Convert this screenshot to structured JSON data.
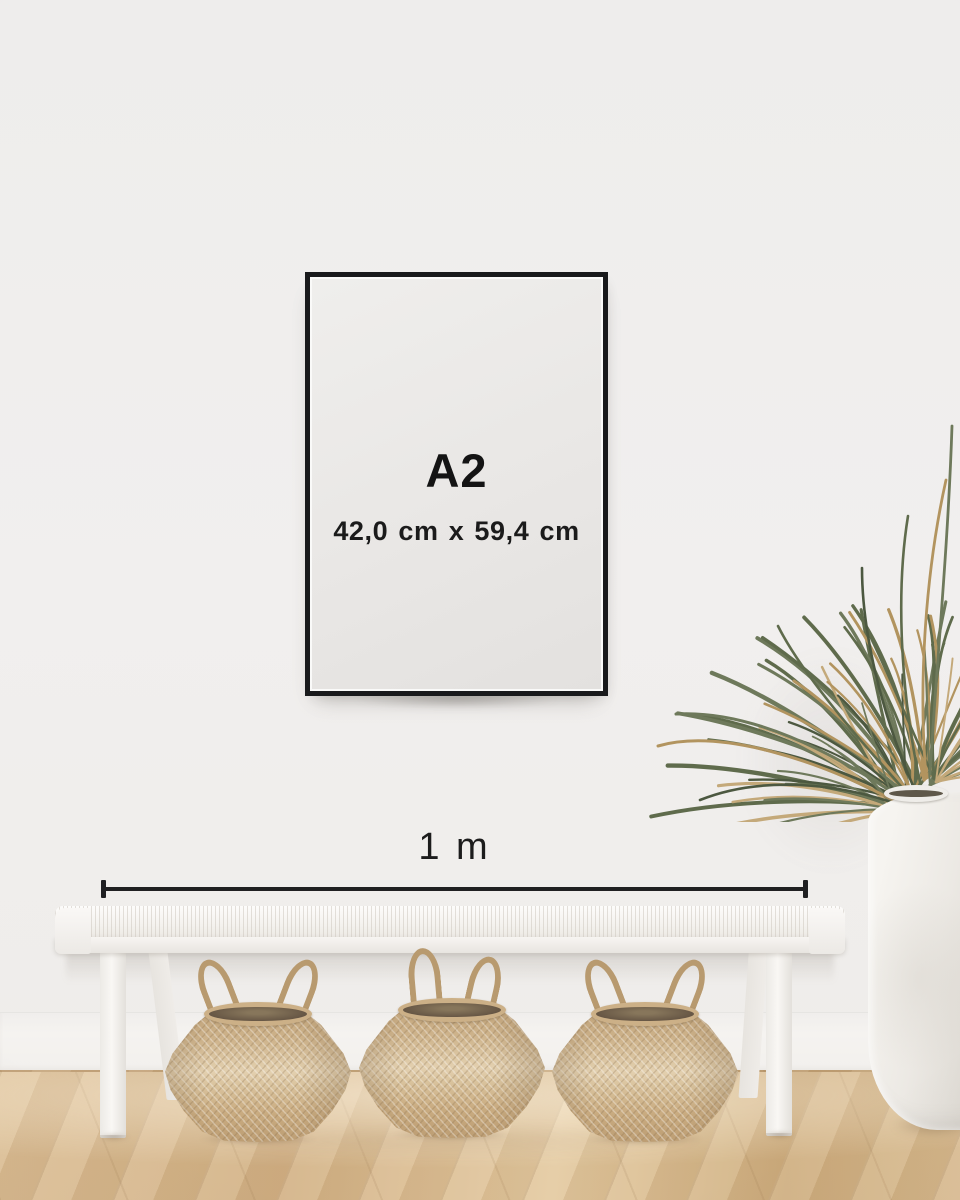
{
  "frame": {
    "size_label": "A2",
    "dimensions_label": "42,0 cm x 59,4 cm"
  },
  "measure": {
    "label": "1 m"
  },
  "colors": {
    "wall": "#f0efee",
    "frame_black": "#191a1c",
    "poster": "#e9e7e5",
    "text": "#161616",
    "measure_line": "#202022",
    "bench_white": "#f5f3f0",
    "basket_tan": "#ccb087",
    "floor_oak": "#d8b88c",
    "leaf_green": "#5f6b4c",
    "leaf_dried_tan": "#b2945f",
    "vase_white": "#ece9e4"
  },
  "scene": {
    "objects": [
      "black-picture-frame",
      "white-woven-bench",
      "seagrass-belly-basket-left",
      "seagrass-belly-basket-middle",
      "seagrass-belly-basket-right",
      "palm-plant",
      "white-ceramic-floor-vase",
      "oak-herringbone-floor"
    ]
  }
}
